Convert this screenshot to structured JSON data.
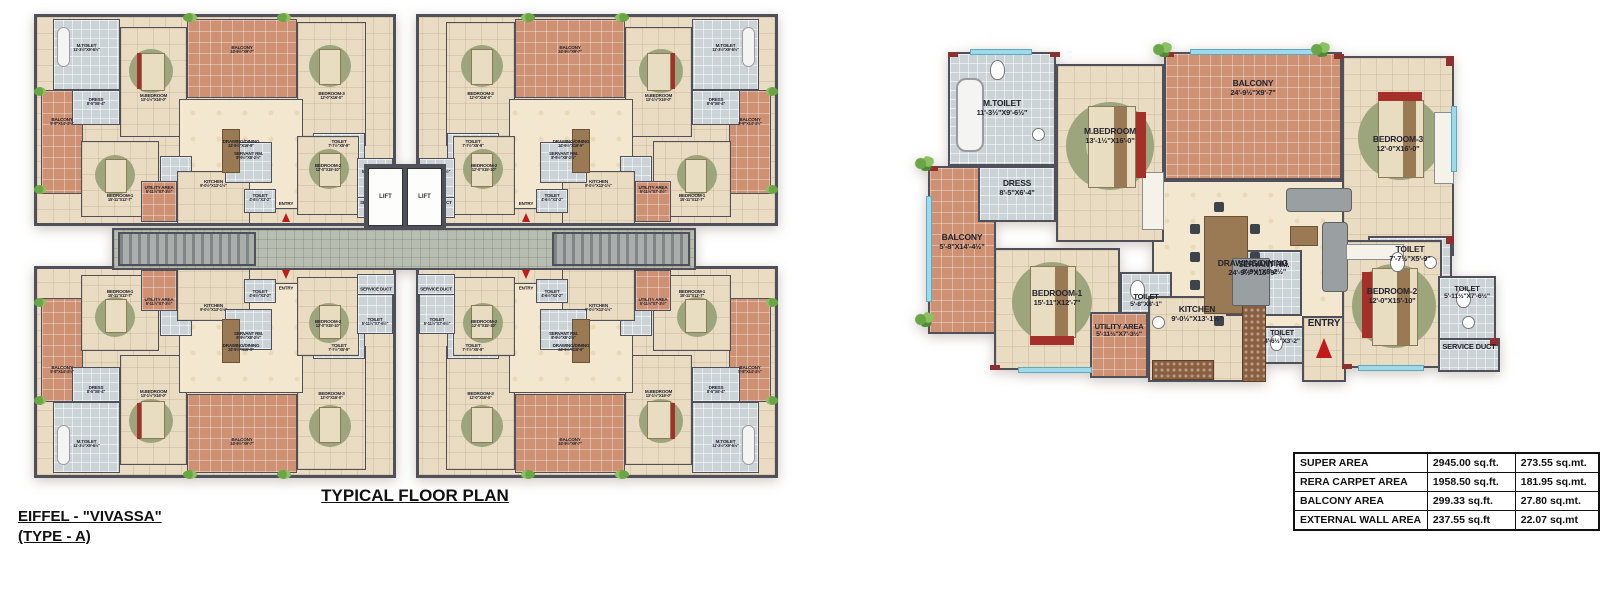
{
  "colors": {
    "wall": "#50505a",
    "wall_red": "#8e3030",
    "floor": "#e9dcc3",
    "marble": "#f3e8cf",
    "balcony": "#cf9173",
    "toilet": "#ccd3d7",
    "corridor": "#b7bdb0",
    "rug": "#9ca57c",
    "bed": "#e8ddc0",
    "bed_wood": "#9a7a55",
    "sofa_red": "#a5302a",
    "stair": "#a9aeac",
    "window": "#9fd9ec",
    "plant": "#6aa546",
    "orange": "#e8872e",
    "ink": "#23232e"
  },
  "left_plan": {
    "title": "TYPICAL FLOOR PLAN",
    "project_line1": "EIFFEL - \"VIVASSA\"",
    "project_line2": "(TYPE - A)",
    "lift_label": "LIFT",
    "units": [
      {
        "id": "top-left",
        "mirror_x": false,
        "mirror_y": false
      },
      {
        "id": "top-right",
        "mirror_x": true,
        "mirror_y": false
      },
      {
        "id": "bottom-left",
        "mirror_x": false,
        "mirror_y": true
      },
      {
        "id": "bottom-right",
        "mirror_x": true,
        "mirror_y": true
      }
    ]
  },
  "unit_rooms": {
    "m_toilet": {
      "name": "M.TOILET",
      "dims": "11'-3½\"X9'-6½\""
    },
    "dress": {
      "name": "DRESS",
      "dims": "8'-5\"X6'-4\""
    },
    "balcony_side": {
      "name": "BALCONY",
      "dims": "5'-8\"X14'-4½\""
    },
    "m_bedroom": {
      "name": "M.BEDROOM",
      "dims": "13'-1½\"X16'-0\""
    },
    "balcony_top": {
      "name": "BALCONY",
      "dims": "24'-9½\"X9'-7\""
    },
    "bedroom3": {
      "name": "BEDROOM-3",
      "dims": "12'-0\"X16'-0\""
    },
    "drawing_dining": {
      "name": "DRAWING/DINING",
      "dims": "24'-9½\"X16'-9\""
    },
    "toilet_right": {
      "name": "TOILET",
      "dims": "7'-7½\"X5'-9\""
    },
    "bedroom1": {
      "name": "BEDROOM-1",
      "dims": "15'-11\"X12'-7\""
    },
    "toilet_mid": {
      "name": "TOILET",
      "dims": "5'-8\"X8'-1\""
    },
    "kitchen": {
      "name": "KITCHEN",
      "dims": "9'-0½\"X13'-1½\""
    },
    "utility": {
      "name": "UTILITY AREA",
      "dims": "5'-11½\"X7'-3½\""
    },
    "servant": {
      "name": "SERVANT RM.",
      "dims": "8'-9½\"X8'-2½\""
    },
    "toilet_entry": {
      "name": "TOILET",
      "dims": "4'-6½\"X3'-2\""
    },
    "entry": {
      "name": "ENTRY"
    },
    "bedroom2": {
      "name": "BEDROOM-2",
      "dims": "12'-0\"X15'-10\""
    },
    "toilet_b2": {
      "name": "TOILET",
      "dims": "5'-11½\"X7'-6½\""
    },
    "service_duct": {
      "name": "SERVICE DUCT"
    }
  },
  "header": {
    "type_title": "TYPE A",
    "type_subtitle": "(4 BEDROOM + 4 TOILET + SERVANT ROOM)",
    "plan_label": "UNIT PLAN"
  },
  "disclaimer": {
    "heading": "Disclaimer :",
    "items": [
      "All shown sizes include wall plaster / tile thickness.",
      "All dimensions shown in feet inches are close approximation to metric dimension.",
      "The dimensions and super area mentioned above may vary from unit to unit on completion of construction.",
      "RERA Carpet area includes area between the inner face of the outer wall of the unit.",
      "Super area includes RERA carpet area plus balcony area, external wall area of the unit, common area of the tower, non - tower area of the complex.",
      "1SQ MTR=10.764 SQ FT"
    ]
  },
  "area_table": {
    "rows": [
      {
        "label": "SUPER AREA",
        "sqft": "2945.00 sq.ft.",
        "sqmt": "273.55 sq.mt."
      },
      {
        "label": "RERA CARPET AREA",
        "sqft": "1958.50 sq.ft.",
        "sqmt": "181.95 sq.mt."
      },
      {
        "label": "BALCONY AREA",
        "sqft": "299.33 sq.ft.",
        "sqmt": "27.80 sq.mt."
      },
      {
        "label": "EXTERNAL WALL AREA",
        "sqft": "237.55 sq.ft",
        "sqmt": "22.07 sq.mt"
      }
    ]
  }
}
